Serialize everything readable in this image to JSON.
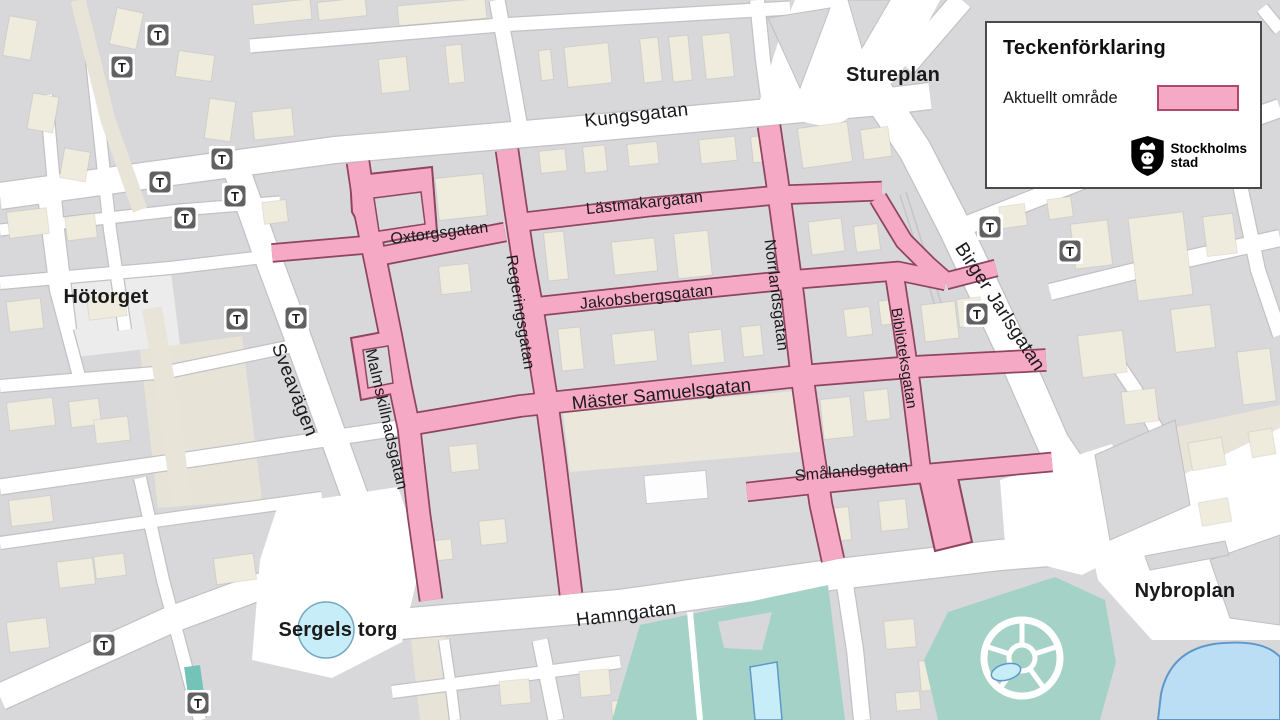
{
  "legend": {
    "title": "Teckenförklaring",
    "items": [
      {
        "label": "Aktuellt område",
        "swatch_color": "#F5A9C4",
        "swatch_border": "#B0486A"
      }
    ],
    "logo": {
      "alt": "Stockholms stad",
      "line1": "Stockholms",
      "line2": "stad"
    }
  },
  "places": {
    "stureplan": "Stureplan",
    "hotorget": "Hötorget",
    "sergels_torg": "Sergels torg",
    "nybroplan": "Nybroplan"
  },
  "streets": {
    "kungsgatan": "Kungsgatan",
    "lastmakargatan": "Lästmakargatan",
    "oxtorgsgatan": "Oxtorgsgatan",
    "regeringsgatan": "Regeringsgatan",
    "jakobsbergsgatan": "Jakobsbergsgatan",
    "norrlandsgatan": "Norrlandsgatan",
    "master_samuelsgatan": "Mäster Samuelsgatan",
    "malmskillnadsgatan": "Malmskillnadsgatan",
    "sveavagen": "Sveavägen",
    "biblioteksgatan": "Biblioteksgatan",
    "smalandsgatan": "Smålandsgatan",
    "hamngatan": "Hamngatan",
    "birger_jarlsgatan": "Birger Jarlsgatan"
  },
  "metro": {
    "symbol": "T"
  },
  "colors": {
    "highlight_fill": "#F5A9C4",
    "highlight_border": "#8E4560",
    "street": "#FFFFFF",
    "block": "#D8D8DB",
    "building": "#EFEBDD",
    "park": "#A5D2C6",
    "water": "#BCDEF4",
    "pond": "#C7EDF8",
    "label": "#1A1A1A"
  }
}
